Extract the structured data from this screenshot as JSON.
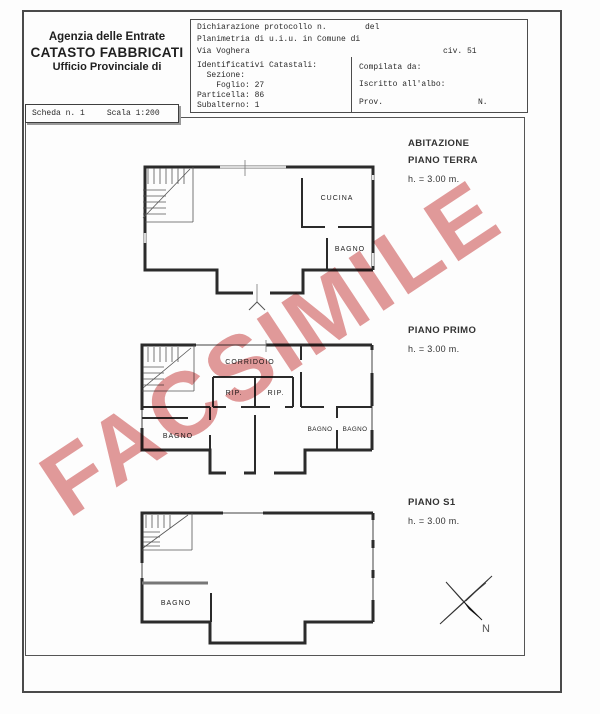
{
  "header": {
    "agency": {
      "line1": "Agenzia delle Entrate",
      "line2": "CATASTO FABBRICATI",
      "line3": "Ufficio Provinciale di"
    },
    "protocol": {
      "row1_left": "Dichiarazione protocollo n.",
      "row1_right": "del",
      "row2": "Planimetria di u.i.u. in Comune di",
      "row3_left": "Via Voghera",
      "row3_right": "civ. 51"
    },
    "catastali": {
      "title": "Identificativi Catastali:",
      "line_sezione": "  Sezione:",
      "line_foglio": "    Foglio: 27",
      "line_particella": "Particella: 86",
      "line_subalterno": "Subalterno: 1"
    },
    "compilata": {
      "row1": "Compilata da:",
      "row2": "Iscritto all'albo:",
      "row3_left": "Prov.",
      "row3_right": "N."
    },
    "scheda": {
      "left": "Scheda n. 1",
      "right": "Scala 1:200"
    }
  },
  "floors": {
    "terra": {
      "title1": "ABITAZIONE",
      "title2": "PIANO TERRA",
      "height": "h. = 3.00 m.",
      "room_cucina": "CUCINA",
      "room_bagno": "BAGNO"
    },
    "primo": {
      "title1": "PIANO PRIMO",
      "height": "h. = 3.00 m.",
      "room_corridoio": "CORRIDOIO",
      "room_rip1": "RIP.",
      "room_rip2": "RIP.",
      "room_bagno_left": "BAGNO",
      "room_bagno_r1": "BAGNO",
      "room_bagno_r2": "BAGNO"
    },
    "s1": {
      "title1": "PIANO S1",
      "height": "h. = 3.00 m.",
      "room_bagno": "BAGNO"
    }
  },
  "watermark": {
    "text": "FACSIMILE",
    "color": "#e29a9a"
  },
  "compass": {
    "north_label": "N"
  }
}
